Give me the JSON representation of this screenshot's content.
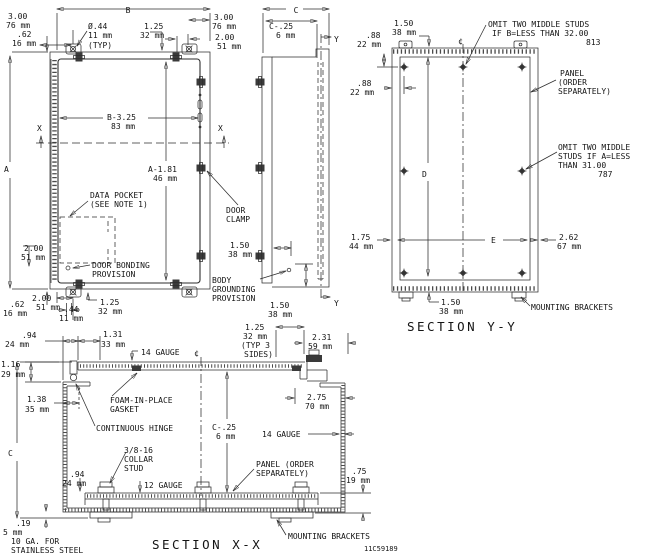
{
  "front_view": {
    "width_label": "B",
    "height_label": "A",
    "section_x_label": "X",
    "dims": {
      "top_offset": [
        "3.00",
        "76 mm"
      ],
      "top_edge": [
        ".62",
        "16 mm"
      ],
      "hole_dia": [
        "Ø.44",
        "11 mm",
        "(TYP)"
      ],
      "clamp_offset": [
        "1.25",
        "32 mm"
      ],
      "top_right_offset": [
        "3.00",
        "76 mm"
      ],
      "top_right_hole": [
        "2.00",
        "51 mm"
      ],
      "inner_width": [
        "B-3.25",
        "83 mm"
      ],
      "inner_height": [
        "A-1.81",
        "46 mm"
      ],
      "bonding_offset": [
        "2.00",
        "51 mm"
      ],
      "bottom_edge": [
        ".62",
        "16 mm"
      ],
      "bottom_offset": [
        "2.00",
        "51 mm"
      ],
      "bottom_slot": [
        ".44",
        "11 mm"
      ],
      "bottom_clamp": [
        "1.25",
        "32 mm"
      ]
    },
    "callouts": {
      "data_pocket": [
        "DATA POCKET",
        "(SEE NOTE 1)"
      ],
      "door_bonding": [
        "DOOR BONDING",
        "PROVISION"
      ]
    }
  },
  "side_view": {
    "depth_label": "C",
    "section_y_label": "Y",
    "dims": {
      "panel_depth": [
        "C-.25",
        "6 mm"
      ],
      "clamp_space": [
        "1.50",
        "38 mm"
      ],
      "grounding_offset": [
        "1.50",
        "38 mm"
      ]
    },
    "callouts": {
      "door_clamp": [
        "DOOR",
        "CLAMP"
      ],
      "body_grounding": [
        "BODY",
        "GROUNDING",
        "PROVISION"
      ]
    }
  },
  "section_yy": {
    "title": "SECTION Y-Y",
    "height_label": "D",
    "width_label": "E",
    "centerline_symbol": "¢",
    "dims": {
      "stud_top": [
        "1.50",
        "38 mm"
      ],
      "stud_edge_v": [
        ".88",
        "22 mm"
      ],
      "stud_edge_h": [
        ".88",
        "22 mm"
      ],
      "bracket_right": [
        "2.62",
        "67 mm"
      ],
      "bracket_left": [
        "1.75",
        "44 mm"
      ],
      "stud_bottom": [
        "1.50",
        "38 mm"
      ]
    },
    "callouts": {
      "omit_b": [
        "OMIT TWO MIDDLE STUDS",
        "IF B=LESS THAN 32.00",
        "813"
      ],
      "panel": [
        "PANEL",
        "(ORDER",
        "SEPARATELY)"
      ],
      "omit_a": [
        "OMIT TWO MIDDLE",
        "STUDS IF A=LESS",
        "THAN 31.00",
        "787"
      ],
      "mounting_brackets": "MOUNTING BRACKETS"
    }
  },
  "section_xx": {
    "title": "SECTION X-X",
    "depth_label": "C",
    "centerline_symbol": "¢",
    "drawing_number": "11C59189",
    "dims": {
      "hinge_offset": [
        ".94",
        "24 mm"
      ],
      "hinge_to_gasket": [
        "1.31",
        "33 mm"
      ],
      "door_overlap": [
        "1.16",
        "29 mm"
      ],
      "wall_to_hinge": [
        "1.38",
        "35 mm"
      ],
      "flange": [
        "1.25",
        "32 mm",
        "(TYP 3",
        "SIDES)"
      ],
      "clamp_offset": [
        "2.31",
        "59 mm"
      ],
      "clamp_to_wall": [
        "2.75",
        "70 mm"
      ],
      "panel_depth": [
        "C-.25",
        "6 mm"
      ],
      "stud_height": [
        ".94",
        "24 mm"
      ],
      "panel_standoff": [
        ".75",
        "19 mm"
      ],
      "bottom_thickness": [
        ".19",
        "5 mm"
      ]
    },
    "callouts": {
      "gauge_door": "14 GAUGE",
      "gauge_body": "14 GAUGE",
      "gauge_panel": "12 GAUGE",
      "foam": [
        "FOAM-IN-PLACE",
        "GASKET"
      ],
      "hinge": "CONTINUOUS HINGE",
      "collar_stud": [
        "3/8-16",
        "COLLAR",
        "STUD"
      ],
      "panel": [
        "PANEL (ORDER",
        "SEPARATELY)"
      ],
      "stainless": [
        "10 GA. FOR",
        "STAINLESS STEEL"
      ],
      "mounting_brackets": "MOUNTING BRACKETS"
    }
  }
}
